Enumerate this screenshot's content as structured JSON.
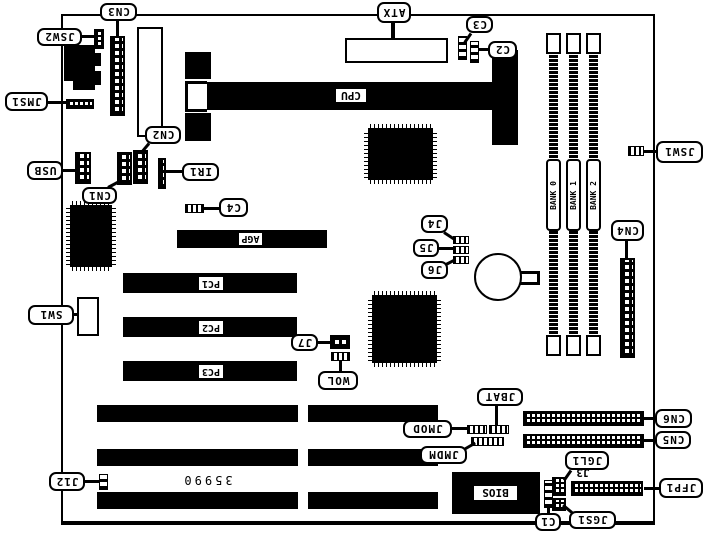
{
  "board": {
    "part_number": "35990",
    "colors": {
      "ink": "#000000",
      "paper": "#ffffff"
    },
    "callouts": {
      "cn3": "CN3",
      "jsw2": "JSW2",
      "jms1": "JMS1",
      "usb": "USB",
      "cn1": "CN1",
      "cn2": "CN2",
      "ir1": "IR1",
      "c4": "C4",
      "atx": "ATX",
      "c3": "C3",
      "c2": "C2",
      "jsw1": "JSW1",
      "cn4": "CN4",
      "j4": "J4",
      "j5": "J5",
      "j6": "J6",
      "j7": "J7",
      "wol": "WOL",
      "sw1": "SW1",
      "j12": "J12",
      "jbat": "JBAT",
      "jmod": "JMOD",
      "jmdm": "JMDM",
      "cn6": "CN6",
      "cn5": "CN5",
      "jgl1": "JGL1",
      "jfp1": "JFP1",
      "jgs1": "JGS1",
      "c1": "C1"
    },
    "slot_labels": {
      "cpu": "CPU",
      "agp": "AGP",
      "pc1": "PC1",
      "pc2": "PC2",
      "pc3": "PC3",
      "bios": "BIOS"
    },
    "bank_labels": [
      "BANK 0",
      "BANK 1",
      "BANK 2"
    ],
    "small_text": {
      "j3": "J3"
    }
  }
}
